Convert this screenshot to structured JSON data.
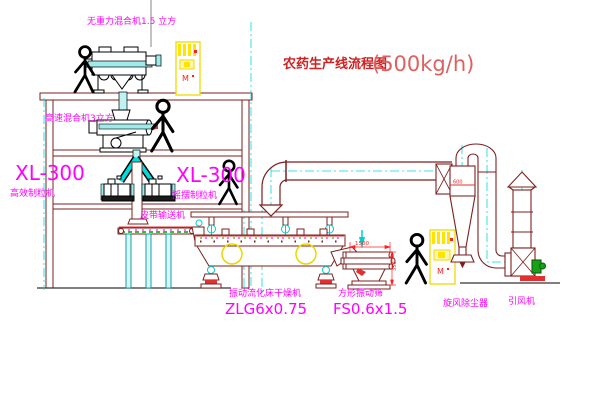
{
  "title": {
    "name": "农药生产线流程图",
    "capacity": "(500kg/h)"
  },
  "equipment_labels": {
    "gravity_mixer": "无重力混合机1.5 立方",
    "high_speed_mixer": "高速混合机3立方",
    "granulator_left_model": "XL-300",
    "granulator_left_name": "高效制粒机",
    "granulator_right_model": "XL-300",
    "granulator_right_name": "摇摆制粒机",
    "belt_conveyor": "皮带输送机",
    "dryer_name": "振动流化床干燥机",
    "dryer_model": "ZLG6x0.75",
    "sieve_name": "方形振动筛",
    "sieve_model": "FS0.6x1.5",
    "cyclone": "旋风除尘器",
    "fan": "引风机"
  },
  "dimensions": {
    "sieve_width": "1500",
    "sieve_height": "350",
    "cyclone_dia": "600"
  },
  "cabinet_labels": {
    "top": "M",
    "bottom": "M"
  },
  "colors": {
    "label_magenta": "#ff00ff",
    "title_red": "#cc2222",
    "capacity_red": "#e06060",
    "line_maroon": "#7d1f1f",
    "cyan": "#00dcdc",
    "yellow": "#f0d800",
    "dim_red": "#ff2020",
    "green": "#18a018"
  }
}
